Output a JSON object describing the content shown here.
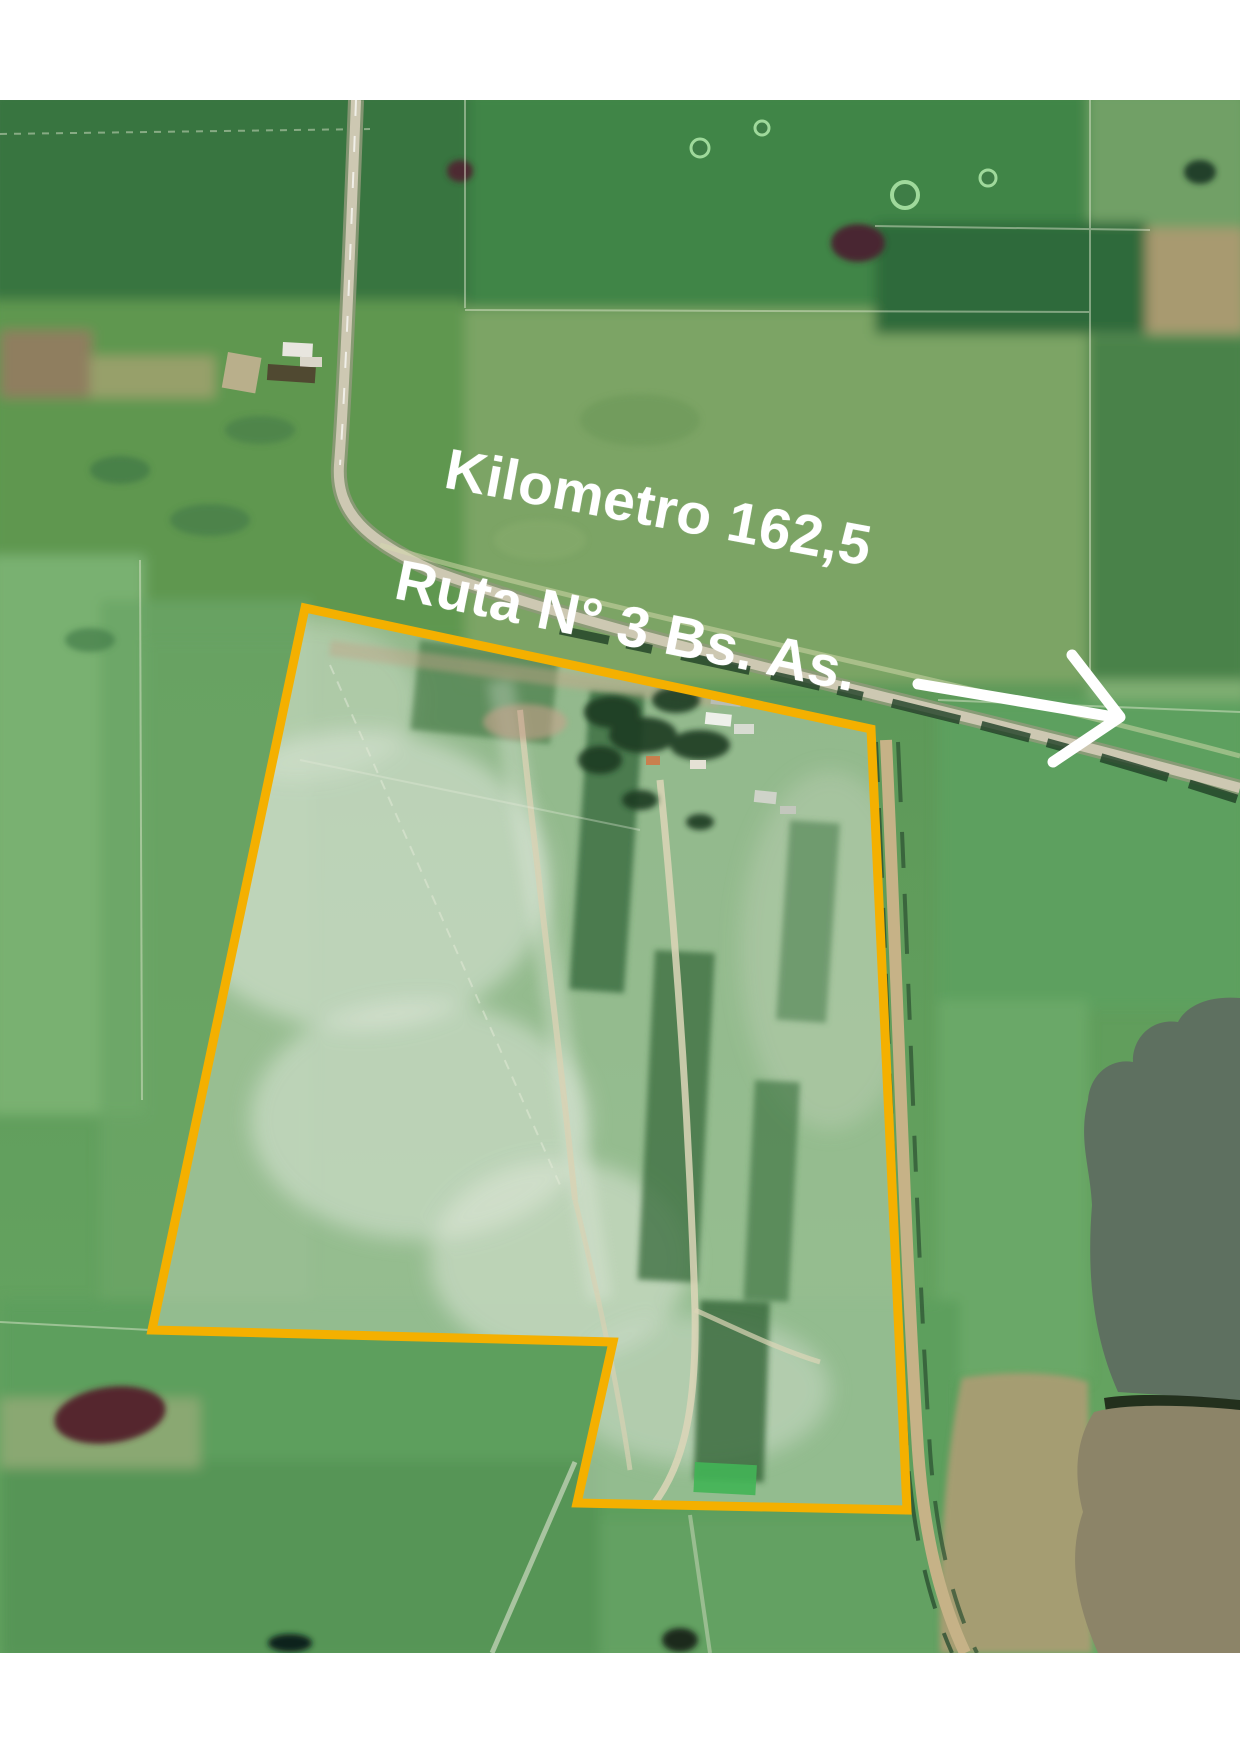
{
  "image": {
    "kind": "aerial-satellite-photo-with-parcel-overlay",
    "annotations": {
      "kilometer_label": "Kilometro 162,5",
      "route_label": "Ruta N° 3 Bs. As."
    },
    "colors": {
      "parcel_boundary": "#F4B000",
      "annotation_text": "#FFFFFF",
      "arrow": "#FFFFFF",
      "letterbox_margin": "#FFFFFF",
      "field_green": "#5D9858",
      "haze_interior": "#C9D8C4",
      "masked_area_gray_green": "#5E7060",
      "masked_area_gray_tan": "#8C8468"
    }
  }
}
